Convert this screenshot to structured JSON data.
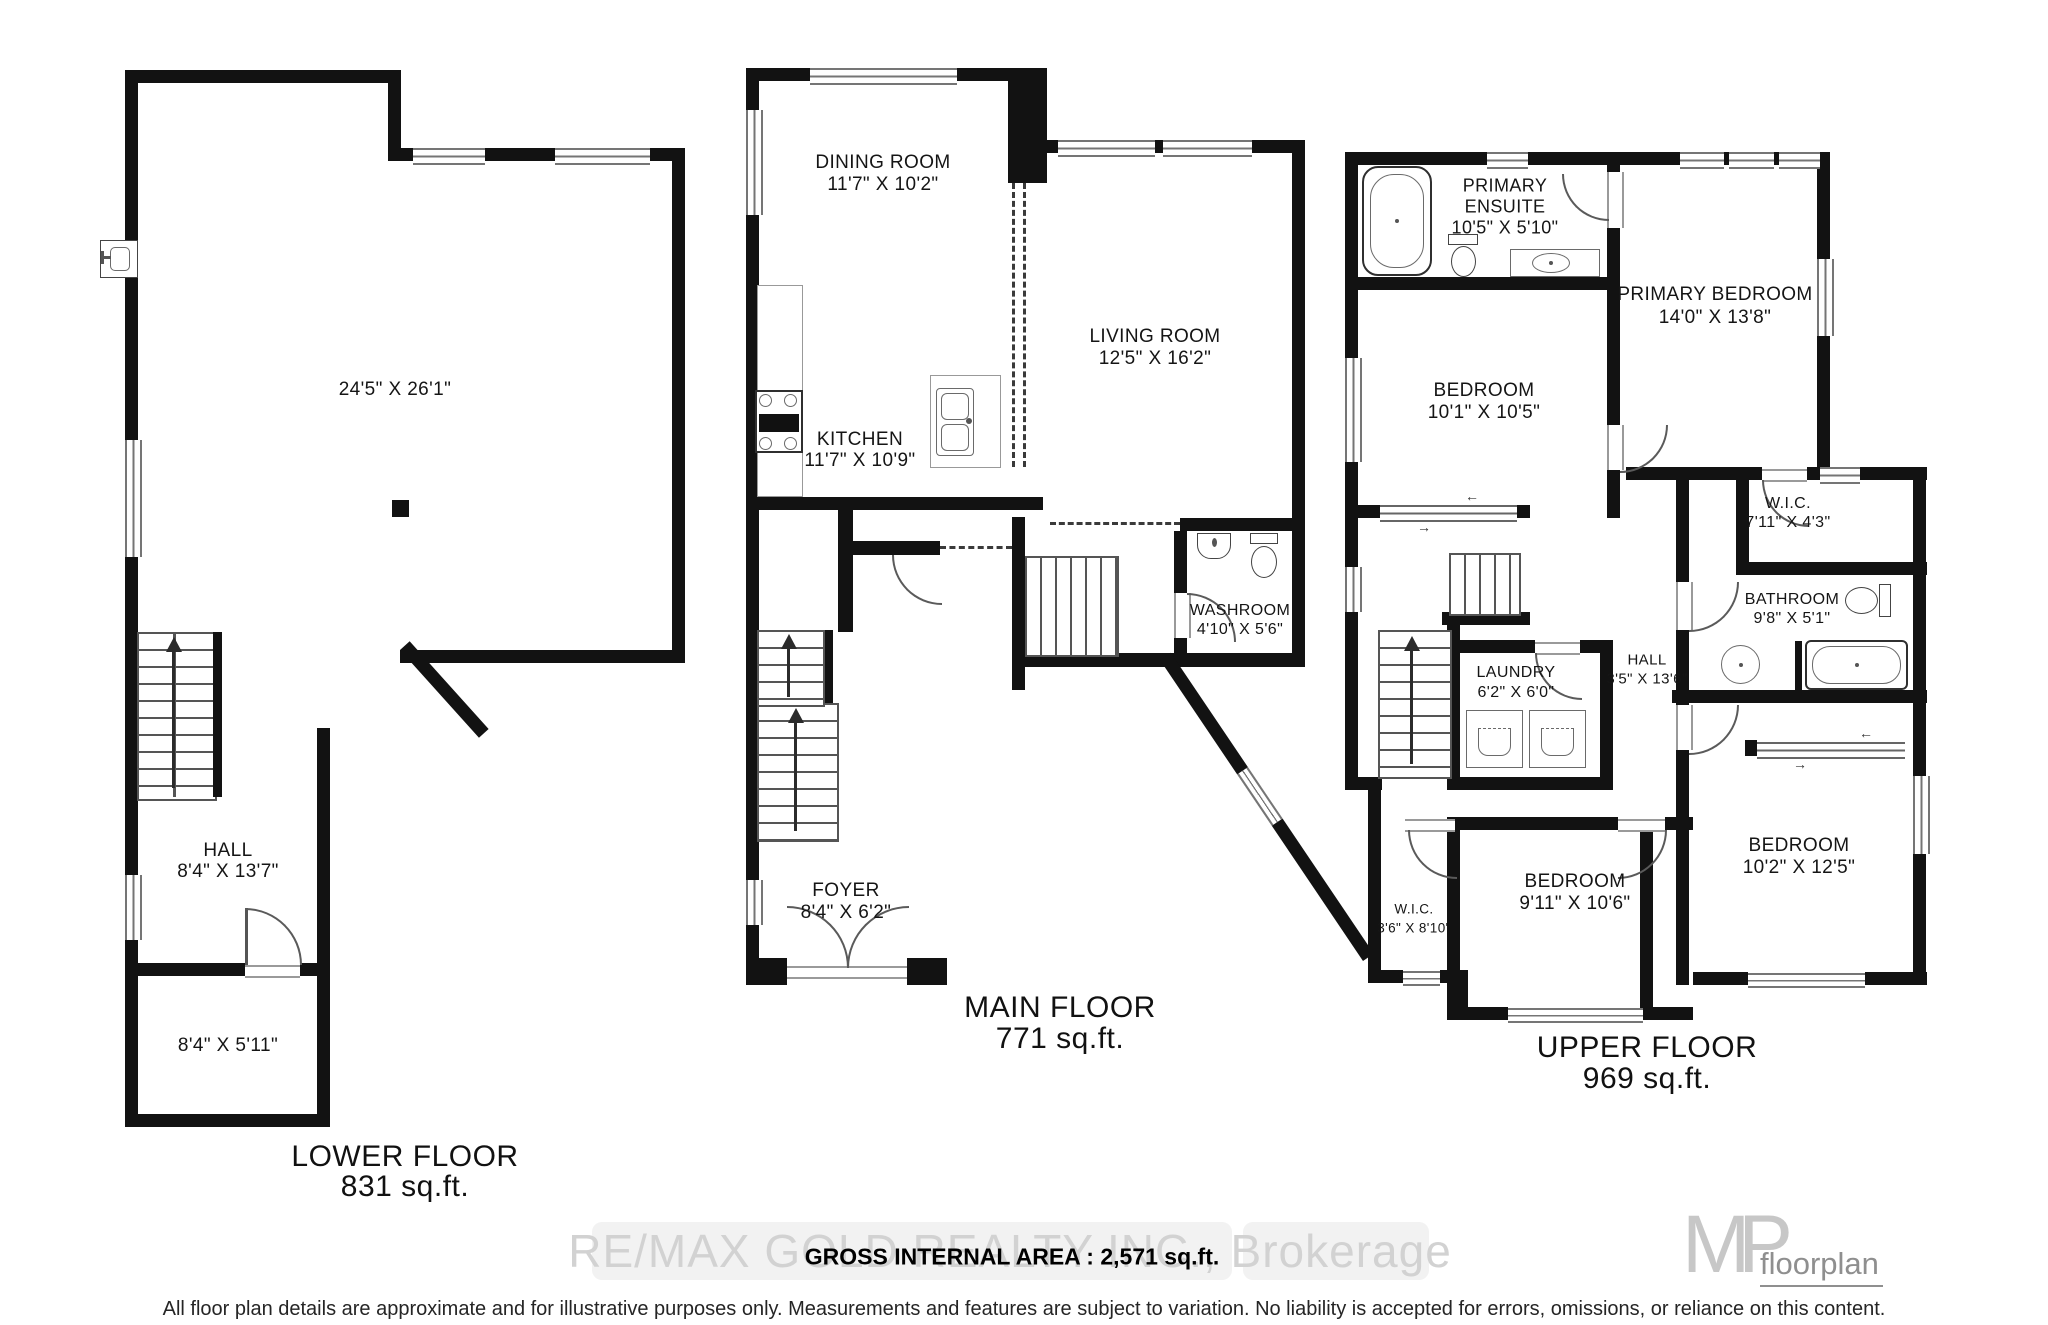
{
  "icons": {
    "up_arrow": "▲",
    "slide_left": "←",
    "slide_right": "→"
  },
  "lower_floor": {
    "title": "LOWER FLOOR",
    "area": "831 sq.ft.",
    "open_area_dims": "24'5\" X 26'1\"",
    "hall": {
      "name": "HALL",
      "dims": "8'4\" X 13'7\""
    },
    "storage_dims": "8'4\" X 5'11\""
  },
  "main_floor": {
    "title": "MAIN FLOOR",
    "area": "771 sq.ft.",
    "dining": {
      "name": "DINING ROOM",
      "dims": "11'7\" X 10'2\""
    },
    "living": {
      "name": "LIVING ROOM",
      "dims": "12'5\" X 16'2\""
    },
    "kitchen": {
      "name": "KITCHEN",
      "dims": "11'7\" X 10'9\""
    },
    "washroom": {
      "name": "WASHROOM",
      "dims": "4'10\" X 5'6\""
    },
    "foyer": {
      "name": "FOYER",
      "dims": "8'4\" X 6'2\""
    }
  },
  "upper_floor": {
    "title": "UPPER FLOOR",
    "area": "969 sq.ft.",
    "primary_ensuite": {
      "name1": "PRIMARY",
      "name2": "ENSUITE",
      "dims": "10'5\" X 5'10\""
    },
    "primary_bedroom": {
      "name": "PRIMARY BEDROOM",
      "dims": "14'0\" X 13'8\""
    },
    "bedroom_left": {
      "name": "BEDROOM",
      "dims": "10'1\" X 10'5\""
    },
    "wic_right": {
      "name": "W.I.C.",
      "dims": "7'11\" X 4'3\""
    },
    "bathroom": {
      "name": "BATHROOM",
      "dims": "9'8\" X 5'1\""
    },
    "hall": {
      "name": "HALL",
      "dims": "3'5\" X 13'6\""
    },
    "laundry": {
      "name": "LAUNDRY",
      "dims": "6'2\" X 6'0\""
    },
    "wic_left": {
      "name": "W.I.C.",
      "dims": "3'6\" X 8'10\""
    },
    "bedroom_middle": {
      "name": "BEDROOM",
      "dims": "9'11\" X 10'6\""
    },
    "bedroom_right": {
      "name": "BEDROOM",
      "dims": "10'2\" X 12'5\""
    }
  },
  "footer": {
    "watermark": "RE/MAX GOLD REALTY INC., Brokerage",
    "gross_area": "GROSS INTERNAL AREA : 2,571 sq.ft.",
    "logo_mp": "MP",
    "logo_floorplan": "floorplan",
    "disclaimer": "All floor plan details are approximate and for illustrative purposes only. Measurements and features are subject to variation. No liability is accepted for errors, omissions, or reliance on this content."
  }
}
